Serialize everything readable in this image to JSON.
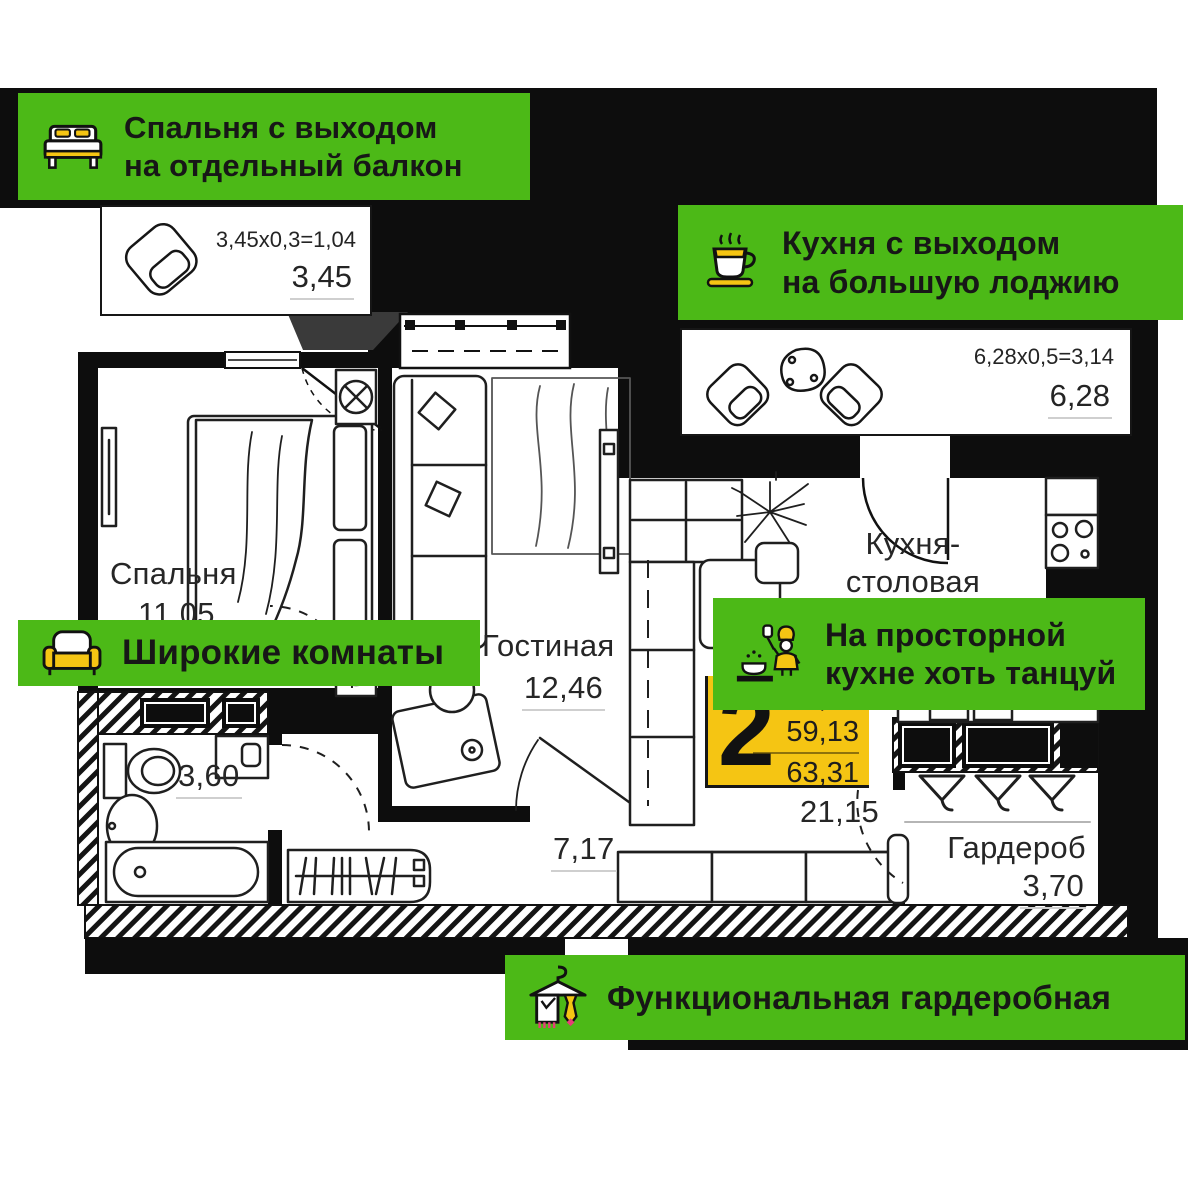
{
  "colors": {
    "green": "#4CB917",
    "yellow": "#F5C513",
    "ink": "#161616",
    "pink": "#E63E77",
    "wall": "#0D0D0D"
  },
  "banners": {
    "bedroom_balcony": {
      "icon": "bed-icon",
      "line1": "Спальня с выходом",
      "line2": "на отдельный балкон"
    },
    "kitchen_loggia": {
      "icon": "coffee-cup-icon",
      "line1": "Кухня с выходом",
      "line2": "на большую лоджию"
    },
    "wide_rooms": {
      "icon": "sofa-icon",
      "line1": "Широкие комнаты"
    },
    "spacious_kitchen": {
      "icon": "chef-icon",
      "line1": "На просторной",
      "line2": "кухне хоть танцуй"
    },
    "functional_wardrobe": {
      "icon": "hanger-icon",
      "line1": "Функциональная гардеробная"
    }
  },
  "plan": {
    "bedroom": {
      "name": "Спальня",
      "area": "11,05"
    },
    "living_room": {
      "name": "Гостиная",
      "area": "12,46"
    },
    "kitchen_dining": {
      "name_line1": "Кухня-",
      "name_line2": "столовая",
      "area": "21,15"
    },
    "bathroom": {
      "area": "3,60"
    },
    "hallway": {
      "area": "7,17"
    },
    "wardrobe": {
      "name": "Гардероб",
      "area": "3,70"
    },
    "bedroom_balcony": {
      "dimensions": "3,45x0,3=1,04",
      "area": "3,45"
    },
    "kitchen_loggia": {
      "dimensions": "6,28x0,5=3,14",
      "area": "6,28"
    }
  },
  "badge": {
    "rooms": "2",
    "living_area": "23,51",
    "floor_area": "59,13",
    "total_area": "63,31"
  }
}
